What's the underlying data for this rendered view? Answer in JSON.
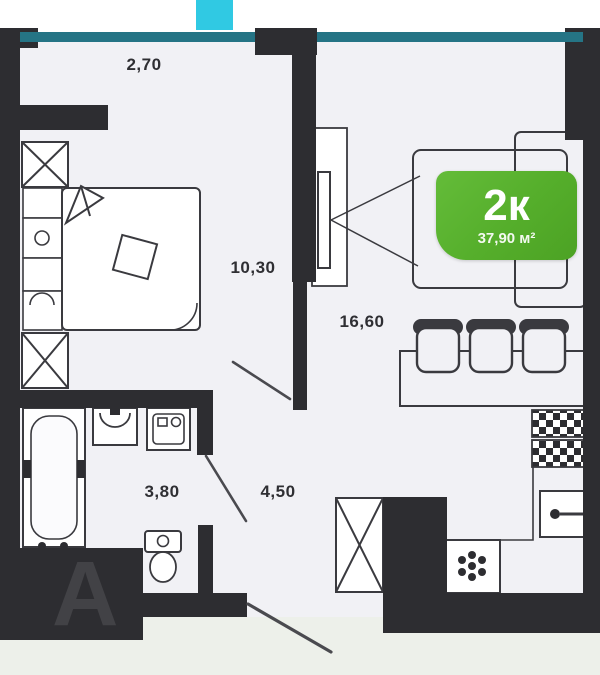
{
  "plan": {
    "type": "apartment-floor-plan",
    "badge": {
      "rooms": "2к",
      "area": "37,90 м²"
    },
    "dimensions": {
      "top": "2,70",
      "bedroom": "10,30",
      "living_kitchen": "16,60",
      "bathroom": "3,80",
      "hallway": "4,50"
    },
    "watermark": "А",
    "colors": {
      "wall": "#2d2d31",
      "window_band": "#257485",
      "marker": "#30c9e3",
      "floor": "#f1f1f5",
      "outside": "#edf0ea",
      "badge_green": "#55ae2b",
      "line": "#3a3a3f"
    },
    "fixtures": [
      "bathtub",
      "washbasin",
      "washing-machine",
      "toilet",
      "bed",
      "wardrobe",
      "tv",
      "sofa",
      "bar-counter",
      "bar-stools",
      "stove",
      "kitchen-sink",
      "refrigerator"
    ]
  }
}
